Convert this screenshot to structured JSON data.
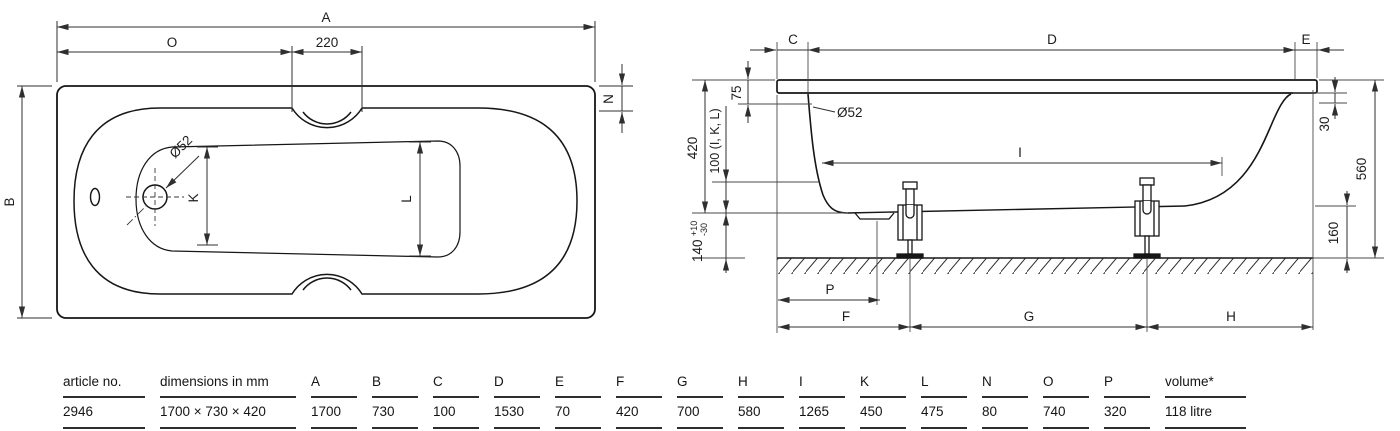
{
  "plan": {
    "labels": {
      "length": "A",
      "drain_offset": "O",
      "grip_width": "220",
      "rim_width": "N",
      "width": "B",
      "drain_dia": "Ø52",
      "inner_head": "K",
      "inner_foot": "L"
    }
  },
  "side": {
    "labels": {
      "overhang": "C",
      "rim_length": "D",
      "edge": "E",
      "inner_length": "I",
      "drain_pos": "P",
      "foot_offset": "F",
      "foot_spacing": "G",
      "foot_end": "H",
      "overflow_offset": "75",
      "depth": "420",
      "measure_ref": "100 (I, K, L)",
      "bottom_height": "140",
      "bottom_tol_plus": "+10",
      "bottom_tol_minus": "-30",
      "drain_dia": "Ø52",
      "rim_edge": "30",
      "total_height": "560",
      "clearance": "160"
    }
  },
  "table": {
    "columns": [
      {
        "h": "article no.",
        "v": "2946"
      },
      {
        "h": "dimensions in mm",
        "v": "1700 × 730 × 420"
      },
      {
        "h": "A",
        "v": "1700"
      },
      {
        "h": "B",
        "v": "730"
      },
      {
        "h": "C",
        "v": "100"
      },
      {
        "h": "D",
        "v": "1530"
      },
      {
        "h": "E",
        "v": "70"
      },
      {
        "h": "F",
        "v": "420"
      },
      {
        "h": "G",
        "v": "700"
      },
      {
        "h": "H",
        "v": "580"
      },
      {
        "h": "I",
        "v": "1265"
      },
      {
        "h": "K",
        "v": "450"
      },
      {
        "h": "L",
        "v": "475"
      },
      {
        "h": "N",
        "v": "80"
      },
      {
        "h": "O",
        "v": "740"
      },
      {
        "h": "P",
        "v": "320"
      },
      {
        "h": "volume*",
        "v": "118 litre"
      }
    ]
  }
}
